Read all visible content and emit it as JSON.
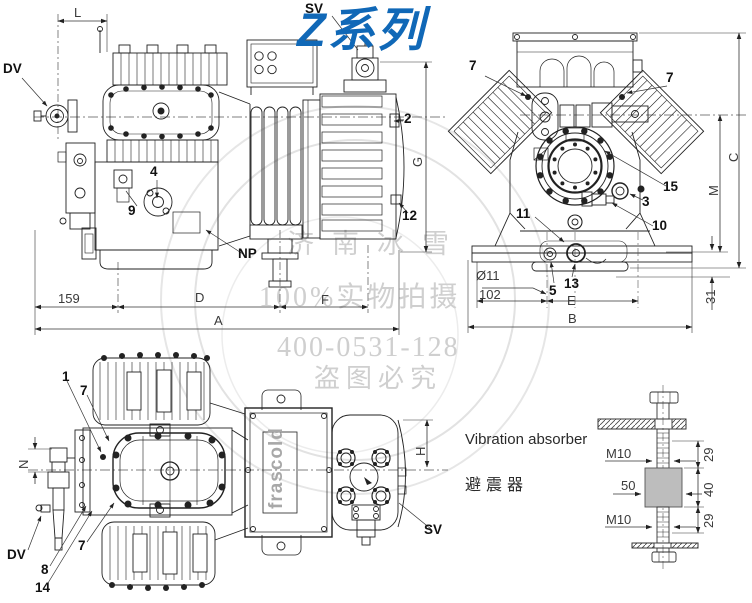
{
  "title": {
    "text": "Z系列",
    "color": "#1068b7"
  },
  "watermark": {
    "line1": "济南冰雪",
    "line2": "100%实物拍摄",
    "line3": "400-0531-128",
    "line4": "盗图必究"
  },
  "side_view": {
    "callouts": {
      "sv": "SV",
      "dv": "DV",
      "n2": "2",
      "n4": "4",
      "n9": "9",
      "np": "NP",
      "n12": "12"
    },
    "dims": {
      "l": "L",
      "g": "G",
      "d159": "159",
      "d": "D",
      "f": "F",
      "a": "A"
    }
  },
  "front_view": {
    "callouts": {
      "n7_left": "7",
      "n7_right": "7",
      "n15": "15",
      "n3": "3",
      "n10": "10",
      "n11": "11",
      "n5": "5",
      "n13": "13"
    },
    "dims": {
      "c": "C",
      "m": "M",
      "dia11": "Ø11",
      "d102": "102",
      "e": "E",
      "b": "B",
      "d31": "31"
    }
  },
  "top_view": {
    "callouts": {
      "n1": "1",
      "n7_top": "7",
      "n7_bottom": "7",
      "n8": "8",
      "n14": "14",
      "dv": "DV",
      "sv": "SV"
    },
    "dims": {
      "n": "N",
      "h": "H"
    },
    "logo": "frascold"
  },
  "absorber": {
    "title_en": "Vibration absorber",
    "title_zh": "避震器",
    "dims": {
      "m10_top": "M10",
      "d50": "50",
      "m10_bottom": "M10",
      "d29_top": "29",
      "d40": "40",
      "d29_bottom": "29"
    }
  }
}
